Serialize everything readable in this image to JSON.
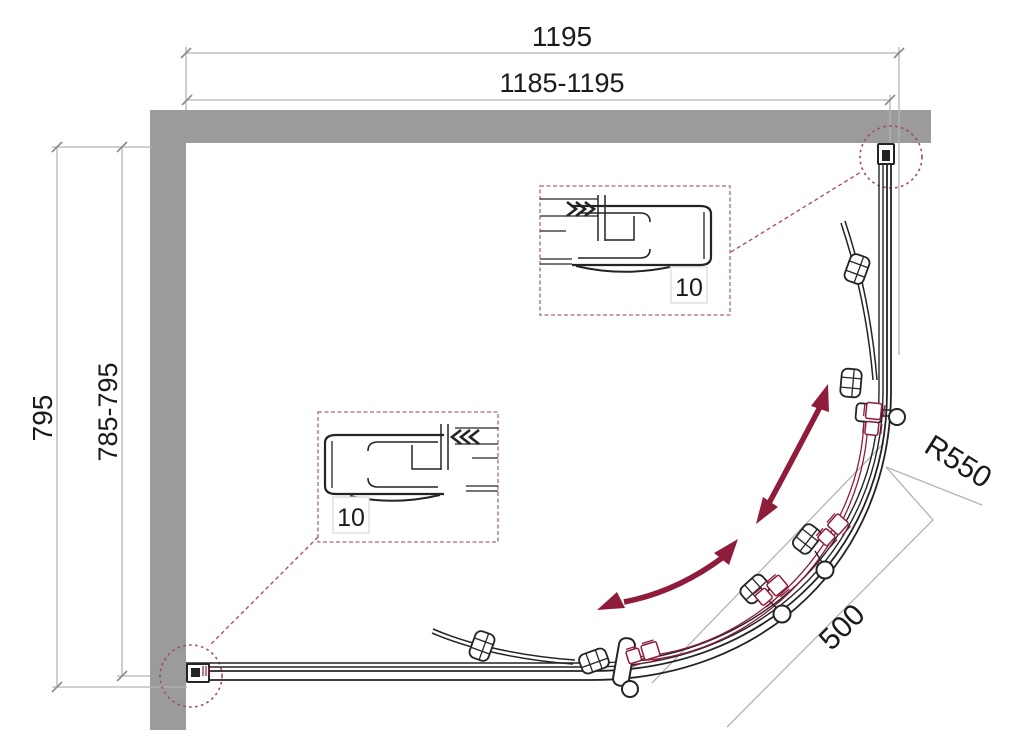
{
  "diagram": {
    "type": "shower-enclosure-top-view-technical-drawing",
    "dimensions": {
      "width_outer": "1195",
      "width_range": "1185-1195",
      "depth_outer": "795",
      "depth_range": "785-795",
      "radius": "R550",
      "door_opening": "500"
    },
    "callouts": {
      "top_profile_label": "10",
      "bottom_profile_label": "10"
    },
    "colors": {
      "wall": "#9b9b9c",
      "drawing_line": "#242424",
      "dimension_line": "#b4b4b4",
      "accent_red": "#8e1c3a",
      "callout_red": "#a5485c"
    }
  }
}
